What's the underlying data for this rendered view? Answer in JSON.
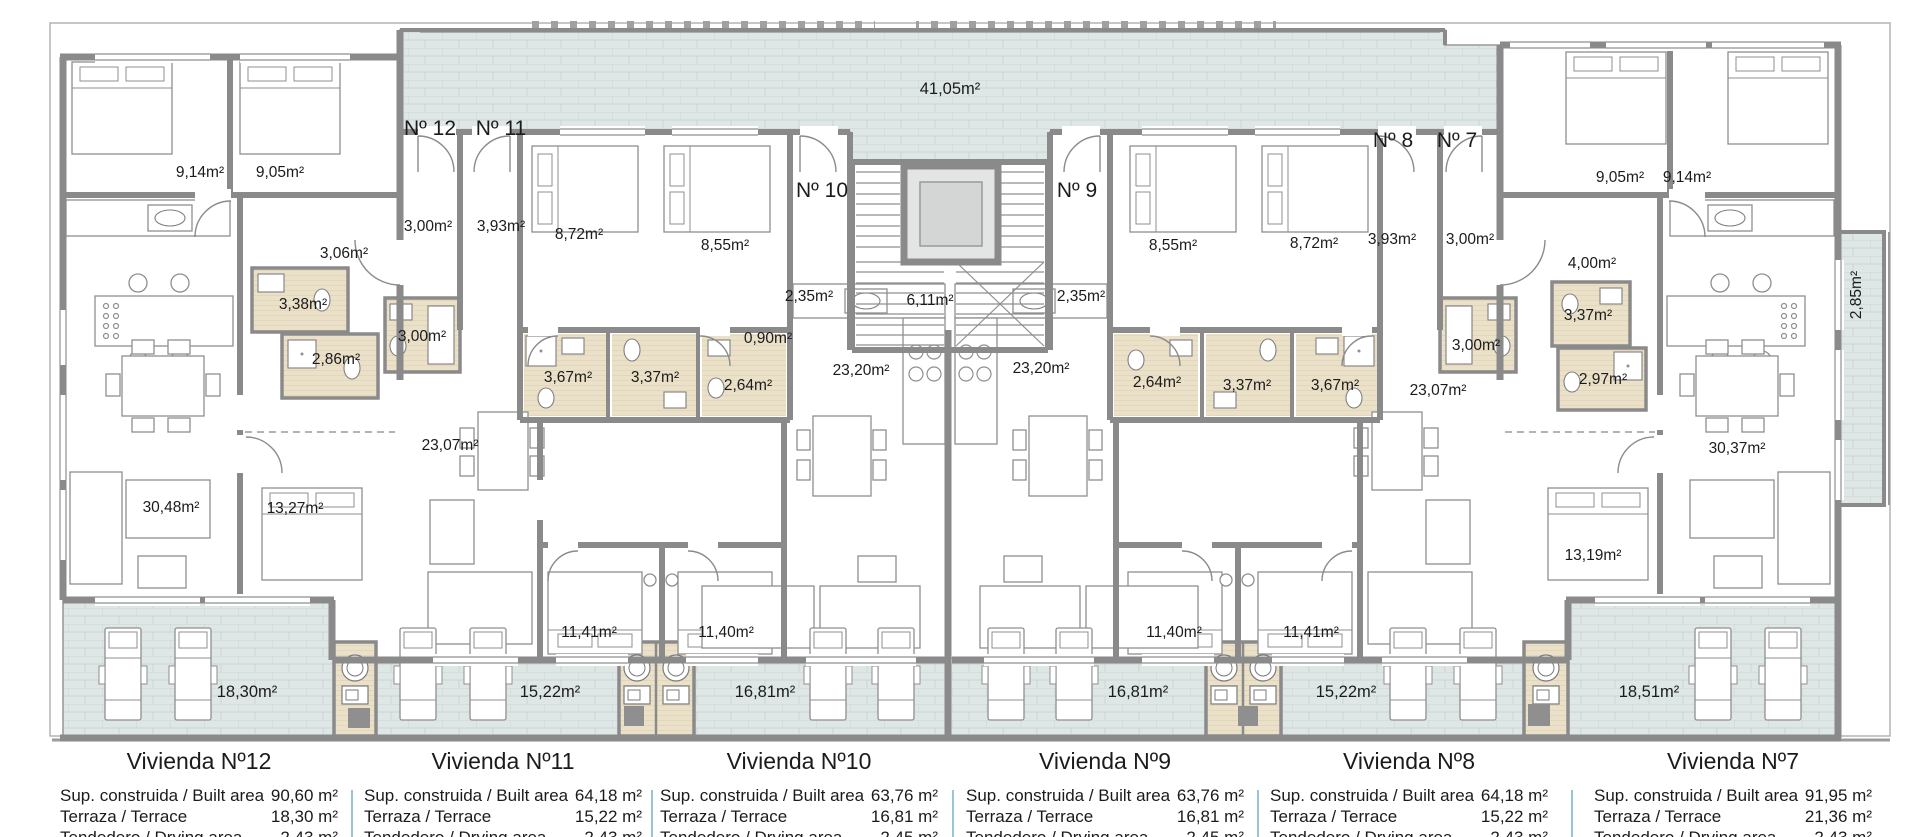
{
  "plan": {
    "room_labels": [
      "9,14m²",
      "9,05m²",
      "3,06m²",
      "3,38m²",
      "2,86m²",
      "30,48m²",
      "13,27m²",
      "3,00m²",
      "3,93m²",
      "8,72m²",
      "8,55m²",
      "3,00m²",
      "3,67m²",
      "3,37m²",
      "23,07m²",
      "11,41m²",
      "11,40m²",
      "2,35m²",
      "0,90m²",
      "2,64m²",
      "23,20m²",
      "6,11m²",
      "41,05m²",
      "23,20m²",
      "2,64m²",
      "2,35m²",
      "8,55m²",
      "8,72m²",
      "3,37m²",
      "3,67m²",
      "3,93m²",
      "3,00m²",
      "3,00m²",
      "23,07m²",
      "4,00m²",
      "3,37m²",
      "2,97m²",
      "9,05m²",
      "9,14m²",
      "30,37m²",
      "13,19m²",
      "11,40m²",
      "11,41m²",
      "2,85m²",
      "18,30m²",
      "15,22m²",
      "16,81m²",
      "16,81m²",
      "15,22m²",
      "18,51m²"
    ],
    "door_labels": [
      "Nº 12",
      "Nº 11",
      "Nº 10",
      "Nº 9",
      "Nº 8",
      "Nº 7"
    ]
  },
  "summary": {
    "built_label": "Sup. construida / Built area",
    "terrace_label": "Terraza / Terrace",
    "row3_label": "Tendedero / Drying area",
    "units": [
      {
        "title": "Vivienda Nº12",
        "built": "90,60 m²",
        "terrace": "18,30 m²",
        "row3": "2,43 m²"
      },
      {
        "title": "Vivienda Nº11",
        "built": "64,18 m²",
        "terrace": "15,22 m²",
        "row3": "2,43 m²"
      },
      {
        "title": "Vivienda Nº10",
        "built": "63,76 m²",
        "terrace": "16,81 m²",
        "row3": "2,45 m²"
      },
      {
        "title": "Vivienda Nº9",
        "built": "63,76 m²",
        "terrace": "16,81 m²",
        "row3": "2,45 m²"
      },
      {
        "title": "Vivienda Nº8",
        "built": "64,18 m²",
        "terrace": "15,22 m²",
        "row3": "2,43 m²"
      },
      {
        "title": "Vivienda Nº7",
        "built": "91,95 m²",
        "terrace": "21,36 m²",
        "row3": "2,43 m²"
      }
    ]
  },
  "colors": {
    "wall": "#8a8a8a",
    "tile": "#dfe7e6",
    "tile_line": "#c9d5d4",
    "bath_floor": "#ebe1c9",
    "divider": "#9cc3d6"
  }
}
